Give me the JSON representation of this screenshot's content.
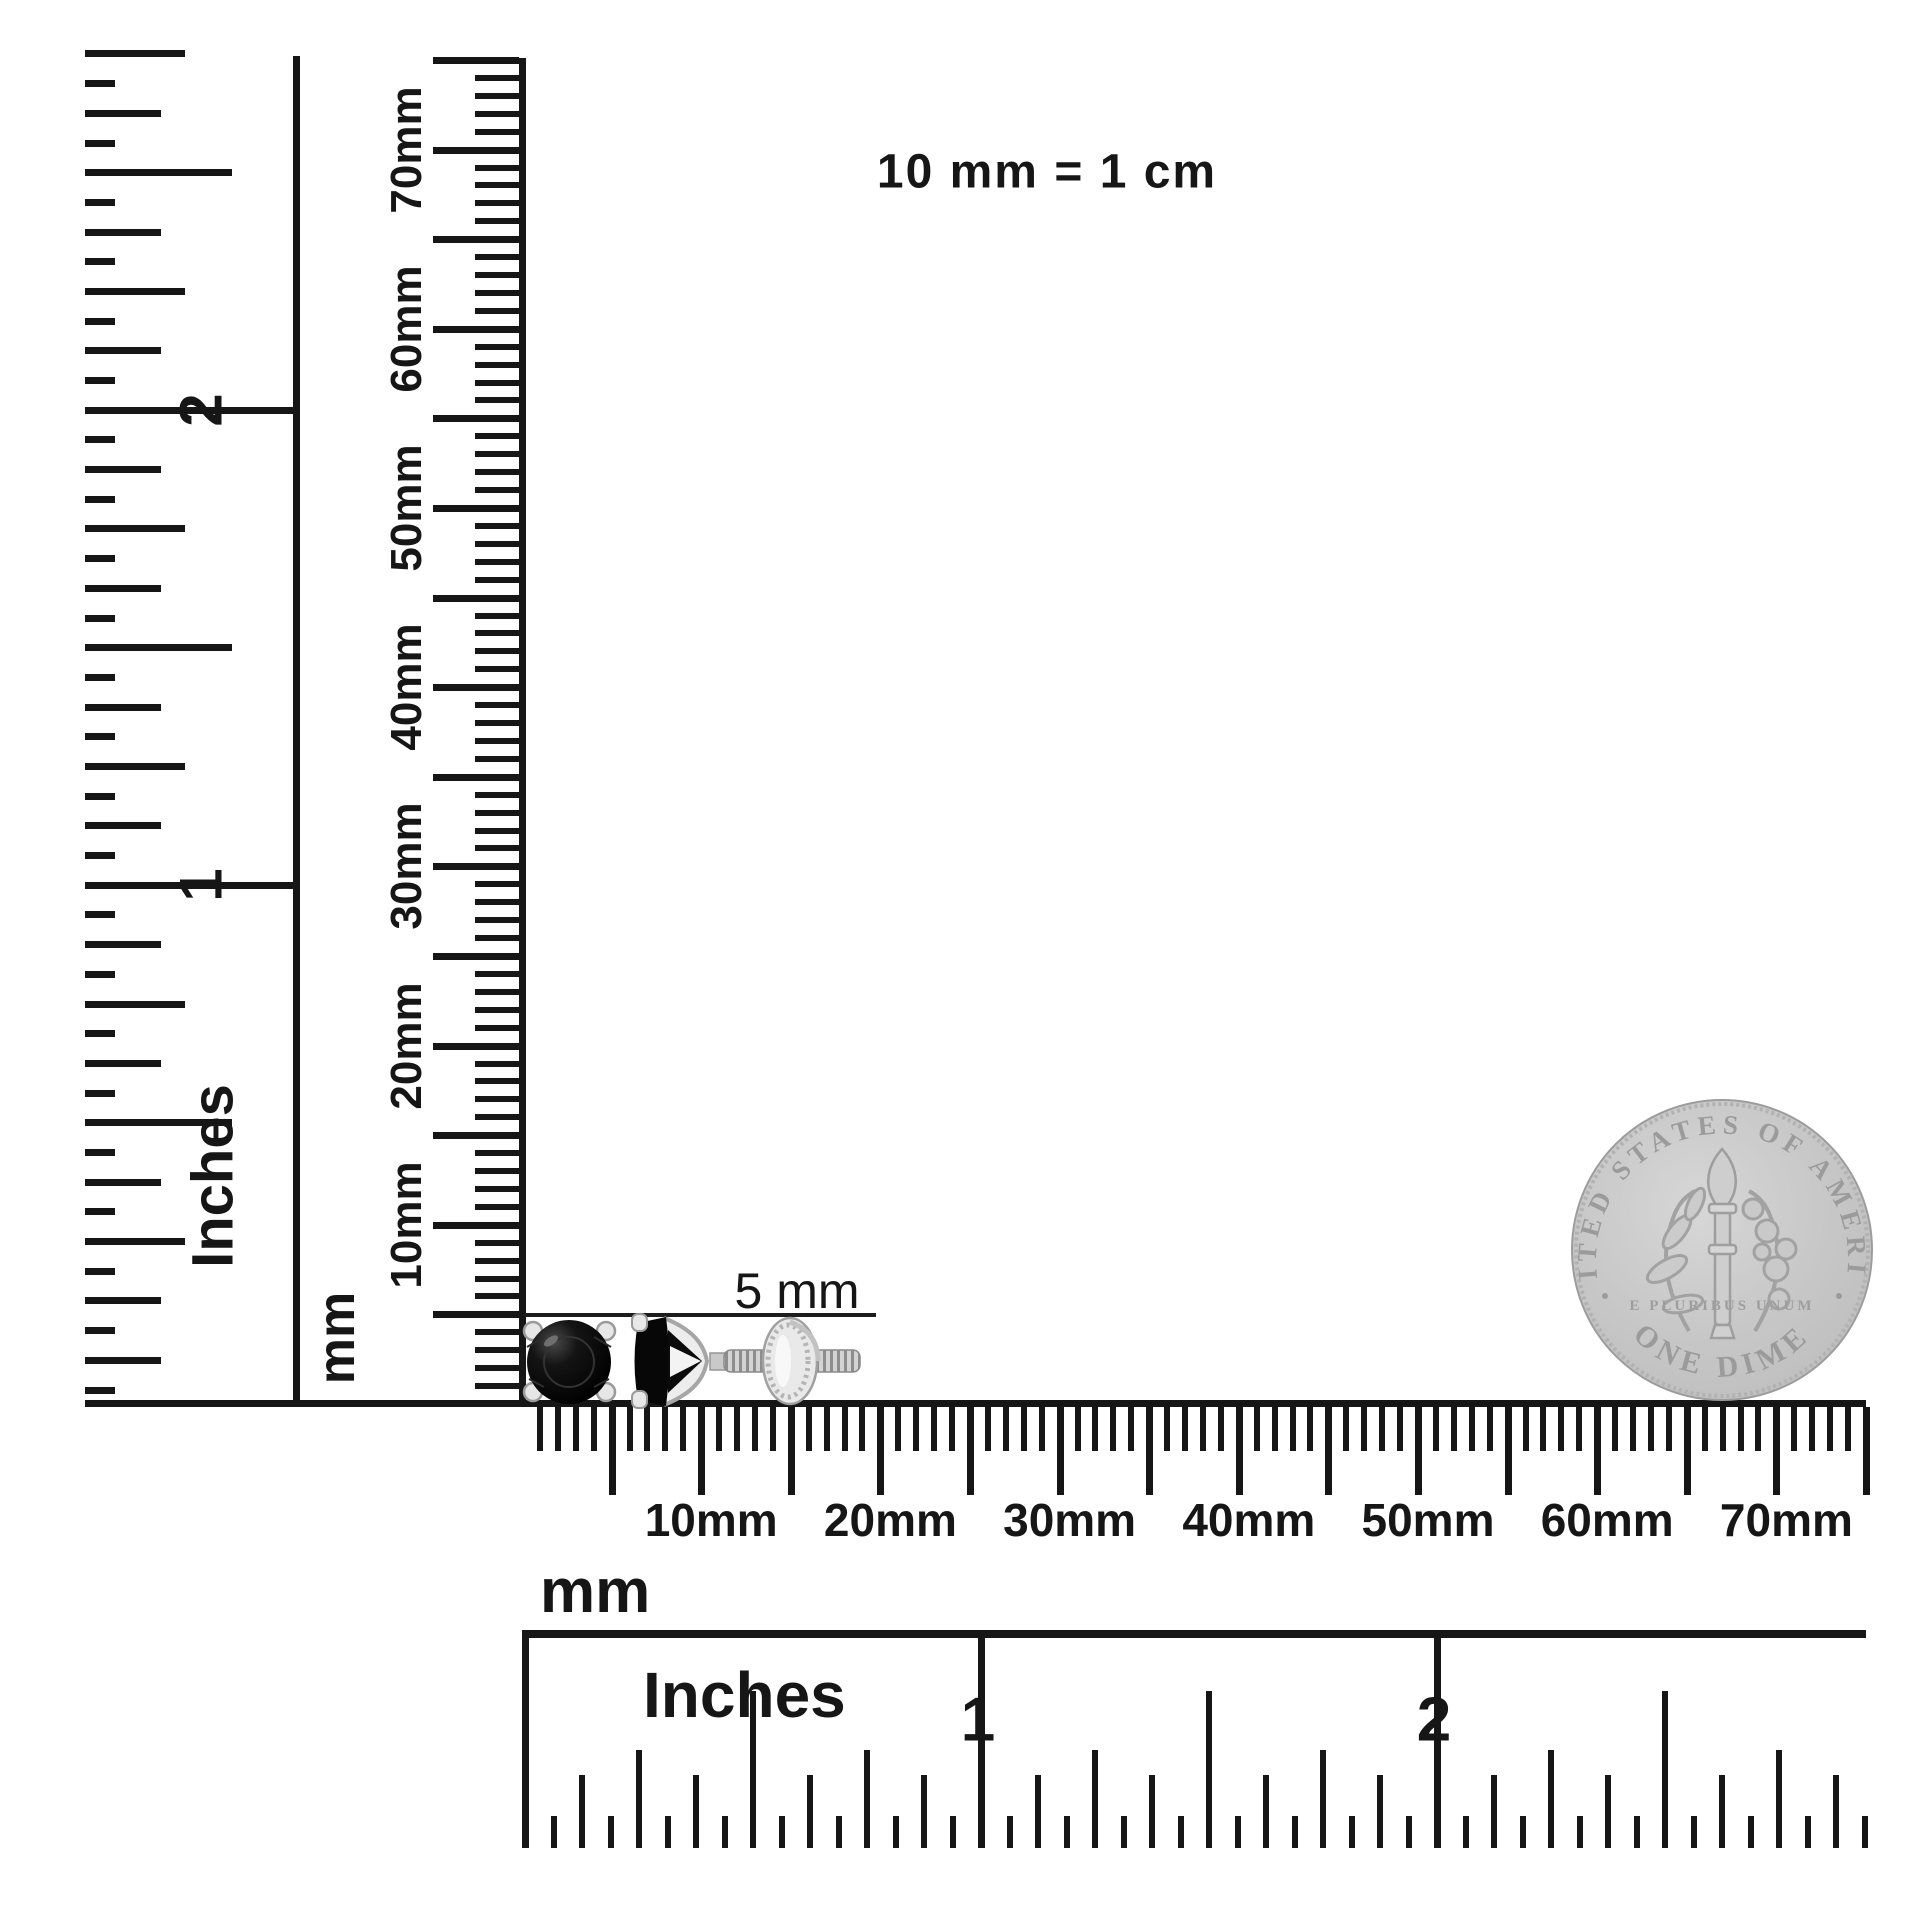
{
  "colors": {
    "background": "#ffffff",
    "ink": "#161616",
    "coin_base": "#c6c6c6",
    "coin_detail": "#9b9b9b",
    "stone": "#0a0a0a",
    "metal": "#dcdcdc"
  },
  "scale_note": {
    "text": "10 mm = 1 cm"
  },
  "size_annotation": {
    "text": "5 mm"
  },
  "vertical_inch_ruler": {
    "unit_label": "Inches",
    "numerals": [
      "1",
      "2"
    ]
  },
  "vertical_mm_ruler": {
    "unit_label": "mm",
    "labels": [
      "10mm",
      "20mm",
      "30mm",
      "40mm",
      "50mm",
      "60mm",
      "70mm"
    ]
  },
  "horizontal_mm_ruler": {
    "unit_label": "mm",
    "labels": [
      "10mm",
      "20mm",
      "30mm",
      "40mm",
      "50mm",
      "60mm",
      "70mm"
    ]
  },
  "horizontal_inch_ruler": {
    "unit_label": "Inches",
    "numerals": [
      "1",
      "2"
    ]
  },
  "coin": {
    "top_text": "UNITED STATES OF AMERICA",
    "motto": "E PLURIBUS UNUM",
    "denomination": "ONE DIME"
  }
}
